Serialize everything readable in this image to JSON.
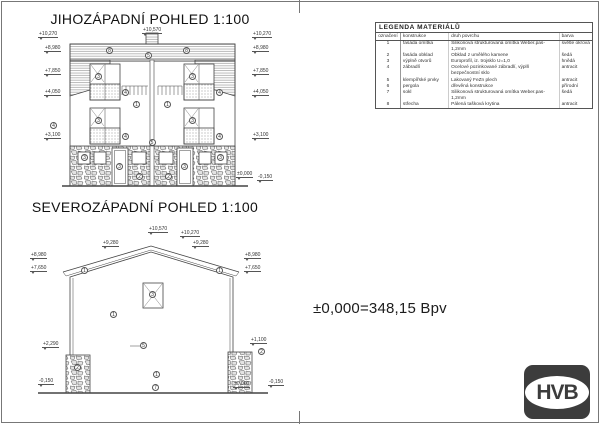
{
  "titles": {
    "sw": "JIHOZÁPADNÍ POHLED 1:100",
    "nw": "SEVEROZÁPADNÍ POHLED 1:100"
  },
  "note": "±0,000=348,15 Bpv",
  "logo": {
    "text": "HVB"
  },
  "legend": {
    "title": "LEGENDA MATERIÁLŮ",
    "headers": [
      "označení",
      "konstrukce",
      "druh povrchu",
      "barva"
    ],
    "rows": [
      [
        "1",
        "fasáda omítka",
        "Silikonová strukturovaná omítka Weber.pas-1,2mm",
        "světle okrová"
      ],
      [
        "2",
        "fasáda obklad",
        "Obklad z umělého kamene",
        "šedá"
      ],
      [
        "3",
        "výplně otvorů",
        "Europrofil, iz. trojsklo U=1,0",
        "hnědá"
      ],
      [
        "4",
        "zábradlí",
        "Ocelové pozinkované zábradlí, výplň bezpečnostní sklo",
        "antracit"
      ],
      [
        "5",
        "klempířské prvky",
        "Lakovaný FeZn plech",
        "antracit"
      ],
      [
        "6",
        "pergola",
        "dřevěná konstrukce",
        "přírodní"
      ],
      [
        "7",
        "sokl",
        "Silikonová strukturovaná omítka Weber.pas-1,2mm",
        "šedá"
      ],
      [
        "8",
        "střecha",
        "Pálená tašková krytina",
        "antracit"
      ]
    ]
  },
  "views": {
    "sw": {
      "marks": [
        "+10,570",
        "+10,270",
        "+8,980",
        "+7,850",
        "+4,050",
        "+3,100",
        "+10,270",
        "+8,980",
        "+7,850",
        "+4,050",
        "+3,100",
        "±0,000",
        "-0,150"
      ],
      "callouts": [
        "8",
        "8",
        "5",
        "3",
        "3",
        "4",
        "4",
        "3",
        "3",
        "4",
        "4",
        "1",
        "1",
        "4",
        "5",
        "3",
        "3",
        "2",
        "2",
        "3",
        "3"
      ]
    },
    "nw": {
      "marks": [
        "+10,570",
        "+10,270",
        "+9,280",
        "+9,280",
        "+8,980",
        "+8,980",
        "+7,650",
        "+7,650",
        "+2,290",
        "-0,150",
        "+1,100",
        "±0,000",
        "-0,150"
      ],
      "callouts": [
        "1",
        "1",
        "3",
        "1",
        "5",
        "1",
        "7",
        "2",
        "2"
      ]
    }
  }
}
